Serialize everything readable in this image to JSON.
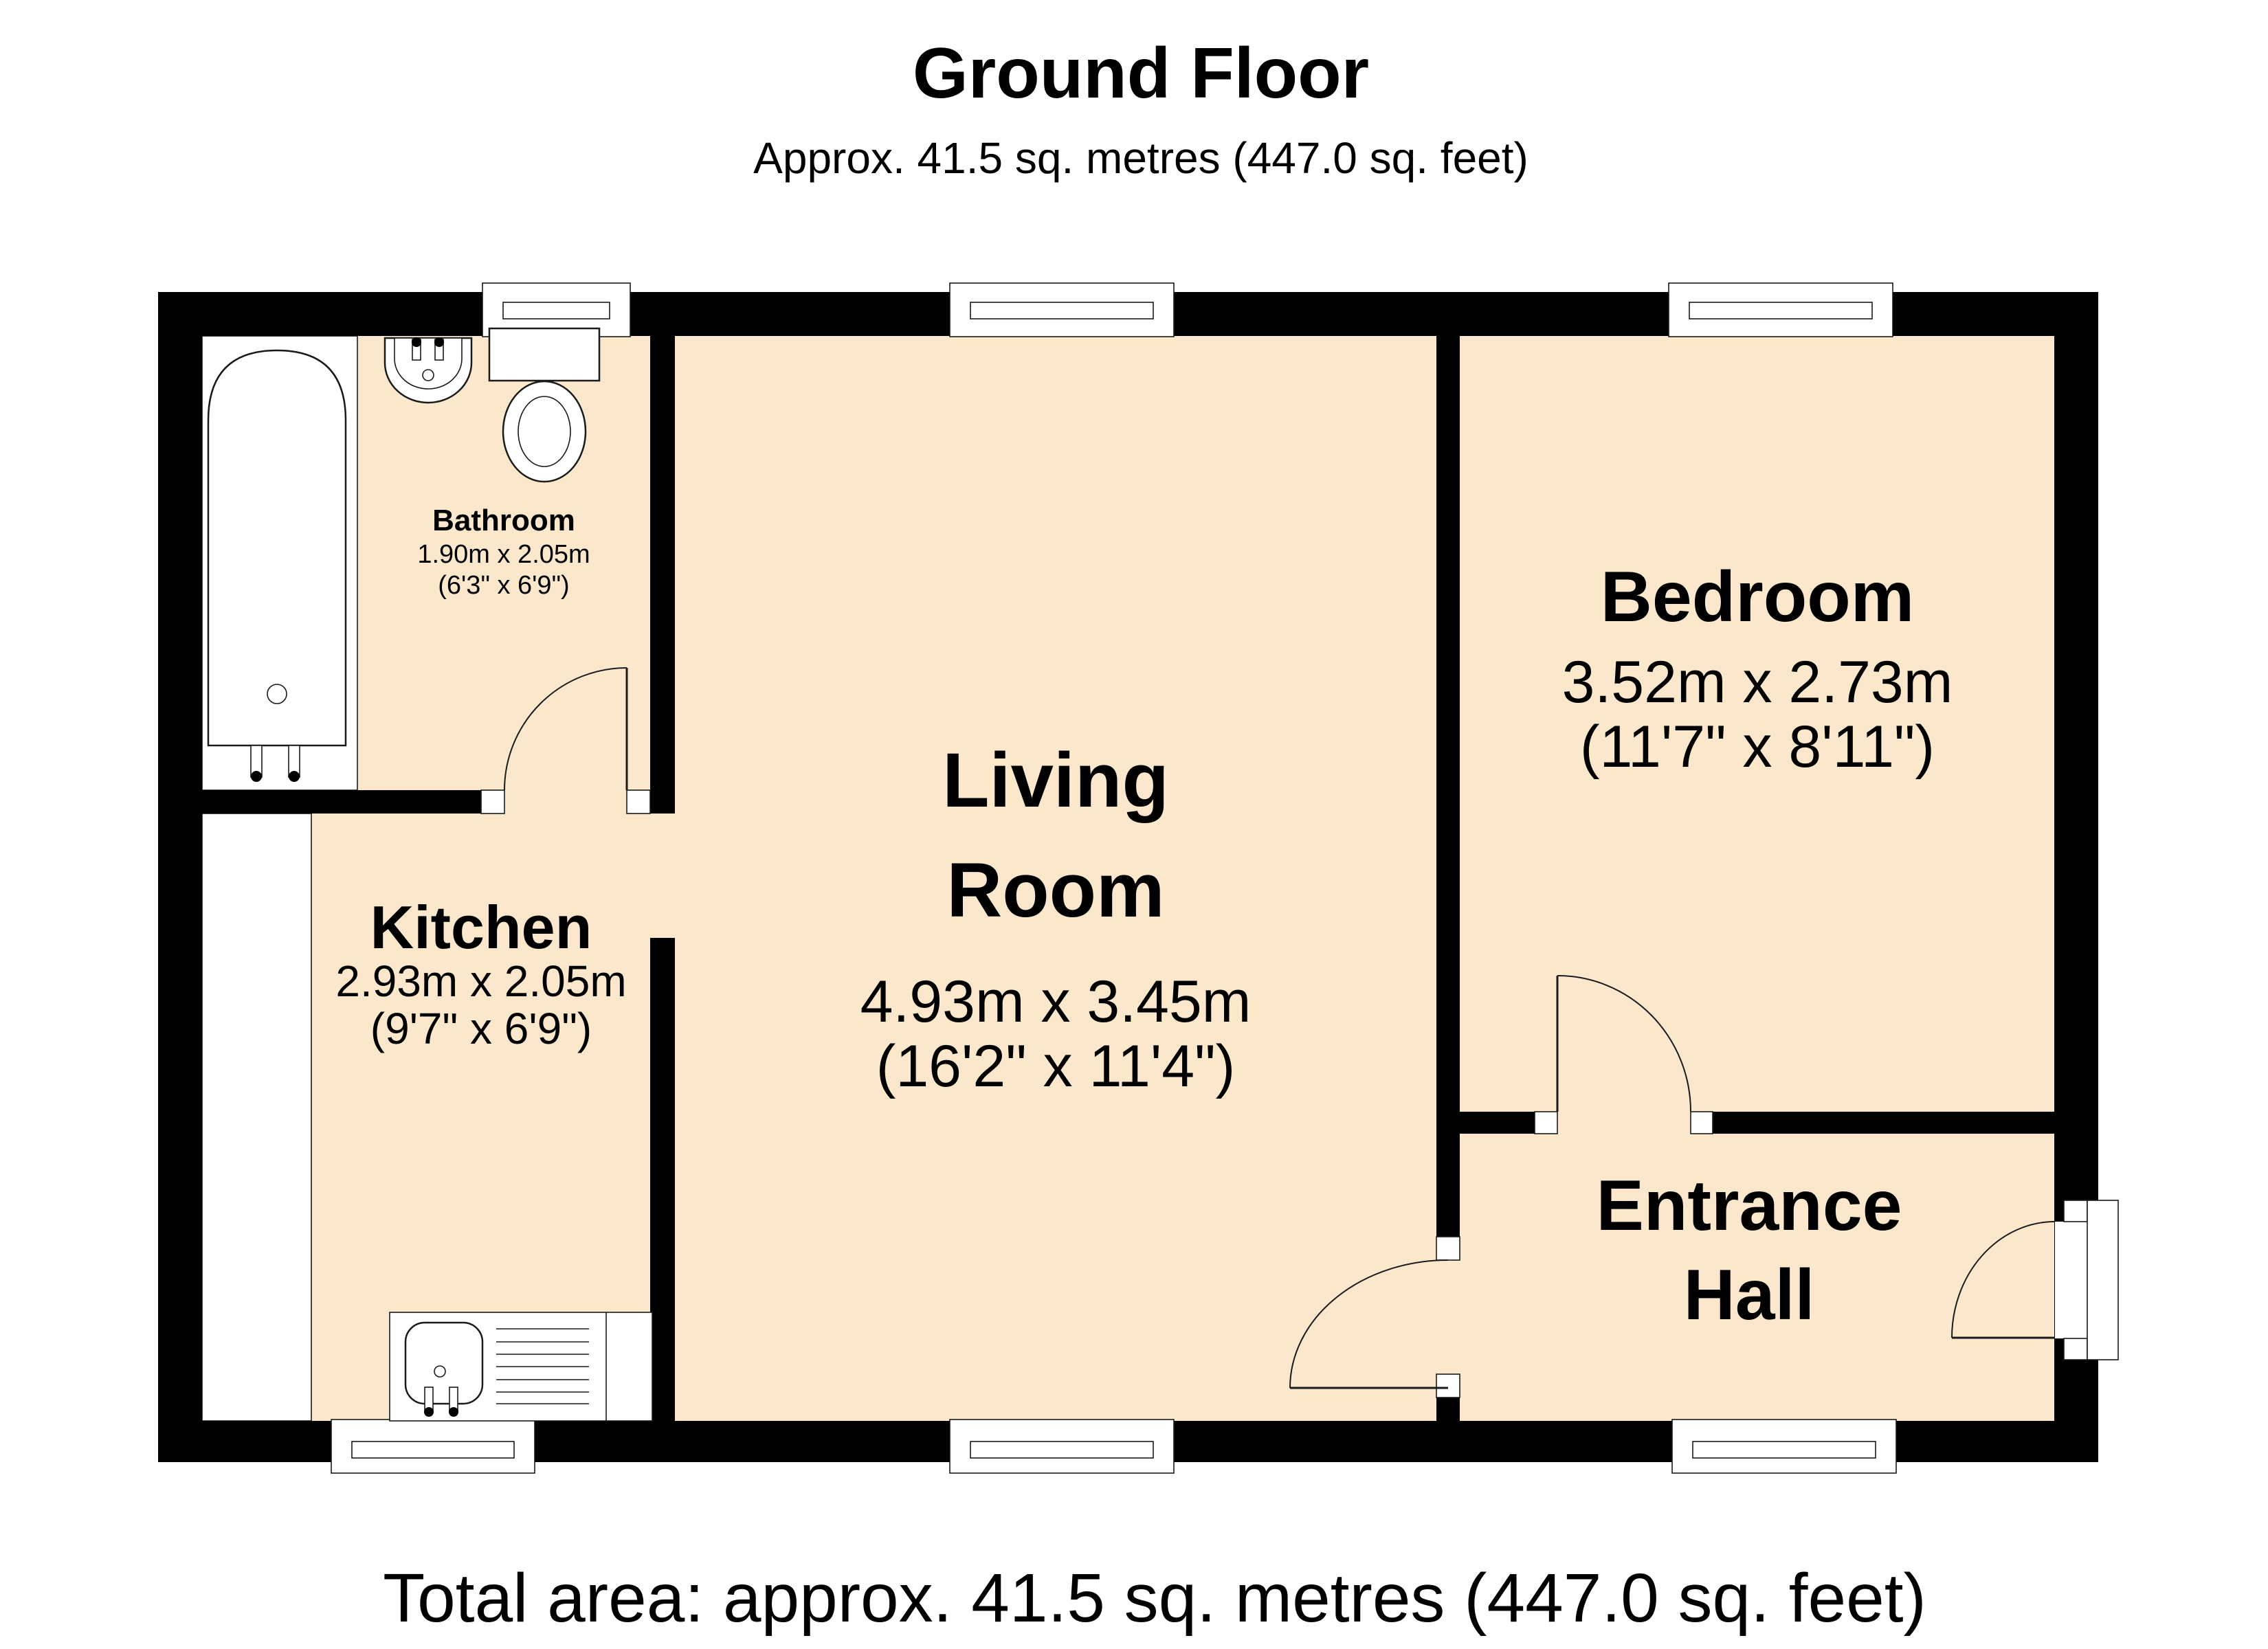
{
  "page": {
    "title": "Ground Floor",
    "subtitle": "Approx. 41.5 sq. metres (447.0 sq. feet)",
    "total_area": "Total area: approx. 41.5 sq. metres (447.0 sq. feet)"
  },
  "rooms": {
    "bathroom": {
      "name": "Bathroom",
      "dims_metric": "1.90m x 2.05m",
      "dims_imperial": "(6'3\" x 6'9\")"
    },
    "kitchen": {
      "name": "Kitchen",
      "dims_metric": "2.93m x 2.05m",
      "dims_imperial": "(9'7\" x 6'9\")"
    },
    "living": {
      "name_line1": "Living",
      "name_line2": "Room",
      "dims_metric": "4.93m x 3.45m",
      "dims_imperial": "(16'2\" x 11'4\")"
    },
    "bedroom": {
      "name": "Bedroom",
      "dims_metric": "3.52m x 2.73m",
      "dims_imperial": "(11'7\" x 8'11\")"
    },
    "entrance_hall": {
      "name_line1": "Entrance",
      "name_line2": "Hall"
    }
  },
  "fixtures": [
    "bathtub",
    "washbasin",
    "toilet",
    "kitchen-sink-drainer"
  ],
  "counts": {
    "windows": 6,
    "doors": 4
  },
  "colors": {
    "floor": "#FBE8CC",
    "wall": "#000000",
    "line": "#1A1A1A",
    "background": "#FFFFFF"
  }
}
